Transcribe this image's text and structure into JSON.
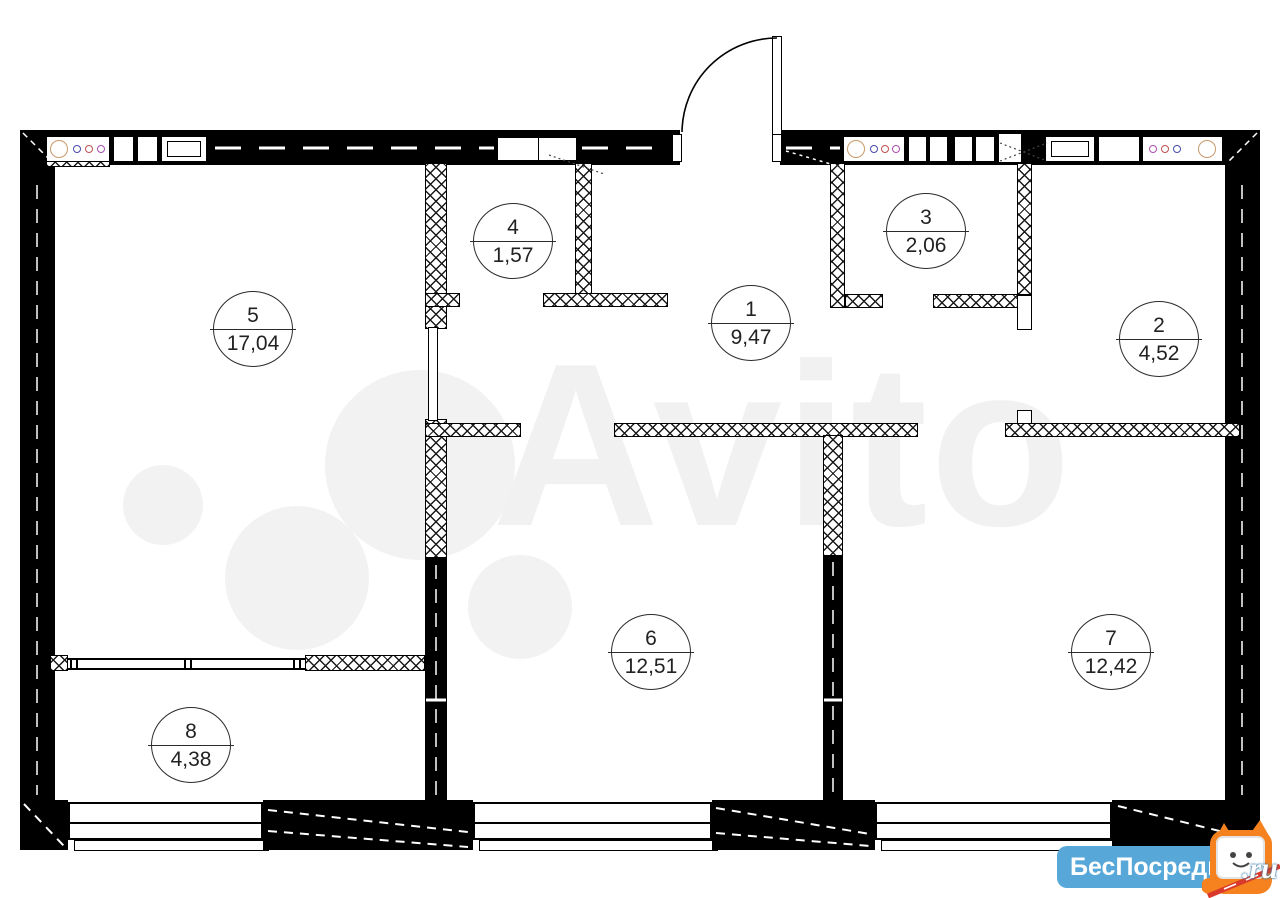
{
  "plan": {
    "rooms": [
      {
        "number": "1",
        "area": "9,47"
      },
      {
        "number": "2",
        "area": "4,52"
      },
      {
        "number": "3",
        "area": "2,06"
      },
      {
        "number": "4",
        "area": "1,57"
      },
      {
        "number": "5",
        "area": "17,04"
      },
      {
        "number": "6",
        "area": "12,51"
      },
      {
        "number": "7",
        "area": "12,42"
      },
      {
        "number": "8",
        "area": "4,38"
      }
    ]
  },
  "watermarks": {
    "avito": "Avito",
    "portal": {
      "name": "БесПосредника",
      "tld": ".ru"
    }
  },
  "icons": {
    "stove": "stove-burners-icon",
    "cabinet": "kitchen-cabinet-icon",
    "door": "door-swing-icon",
    "mascot": "cat-tv-mascot-icon"
  },
  "colors": {
    "wall": "#000000",
    "watermark_gray": "#f1f1f1",
    "badge_blue": "#57a8d8",
    "badge_text": "#ffffff",
    "mascot_orange": "#f5821f",
    "stick_red": "#d93a2b",
    "burner_ring": "#c9996b",
    "burner_dots": [
      "#4a4ab0",
      "#c05050",
      "#aa4fae"
    ]
  }
}
